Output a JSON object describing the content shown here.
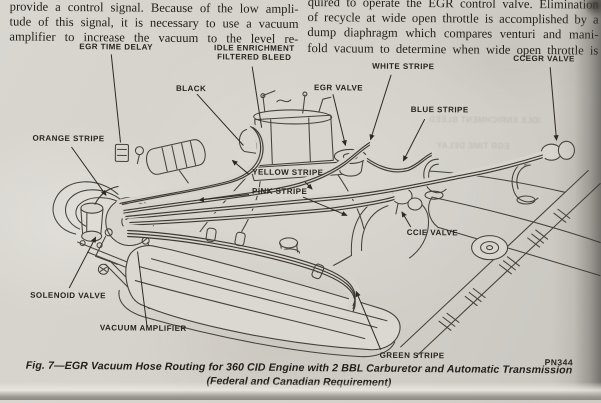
{
  "colors": {
    "paper": "#d5d2cb",
    "ink": "#211e1a",
    "line_art": "#45423c"
  },
  "article": {
    "left_column_lines": [
      "provide a control signal. Because of the low ampli-",
      "tude of this signal, it is necessary to use a vacuum",
      "amplifier to increase the vacuum to the level re-"
    ],
    "right_column_lines": [
      "quired to operate the EGR control valve. Elimination",
      "of recycle at wide open throttle is accomplished by a",
      "dump diaphragm which compares venturi and mani-",
      "fold vacuum to determine when wide open throttle is"
    ]
  },
  "figure": {
    "labels": {
      "egr_time_delay": "EGR TIME DELAY",
      "idle_enrichment": "IDLE ENRICHMENT\nFILTERED BLEED",
      "black": "BLACK",
      "egr_valve": "EGR VALVE",
      "white_stripe": "WHITE STRIPE",
      "ccegr_valve": "CCEGR VALVE",
      "blue_stripe": "BLUE STRIPE",
      "orange_stripe": "ORANGE STRIPE",
      "yellow_stripe": "YELLOW STRIPE",
      "pink_stripe": "PINK STRIPE",
      "ccie_valve": "CCIE VALVE",
      "solenoid_valve": "SOLENOID VALVE",
      "vacuum_amplifier": "VACUUM AMPLIFIER",
      "green_stripe": "GREEN STRIPE"
    },
    "part_number": "PN344",
    "caption_line1": "Fig. 7—EGR Vacuum Hose Routing for 360 CID Engine with 2 BBL Carburetor and Automatic Transmission",
    "caption_line2": "(Federal and Canadian Requirement)",
    "bleedthrough": {
      "g1": "IDLE ENRICHMENT BLEED",
      "g2": "EGR TIME DELAY"
    }
  }
}
